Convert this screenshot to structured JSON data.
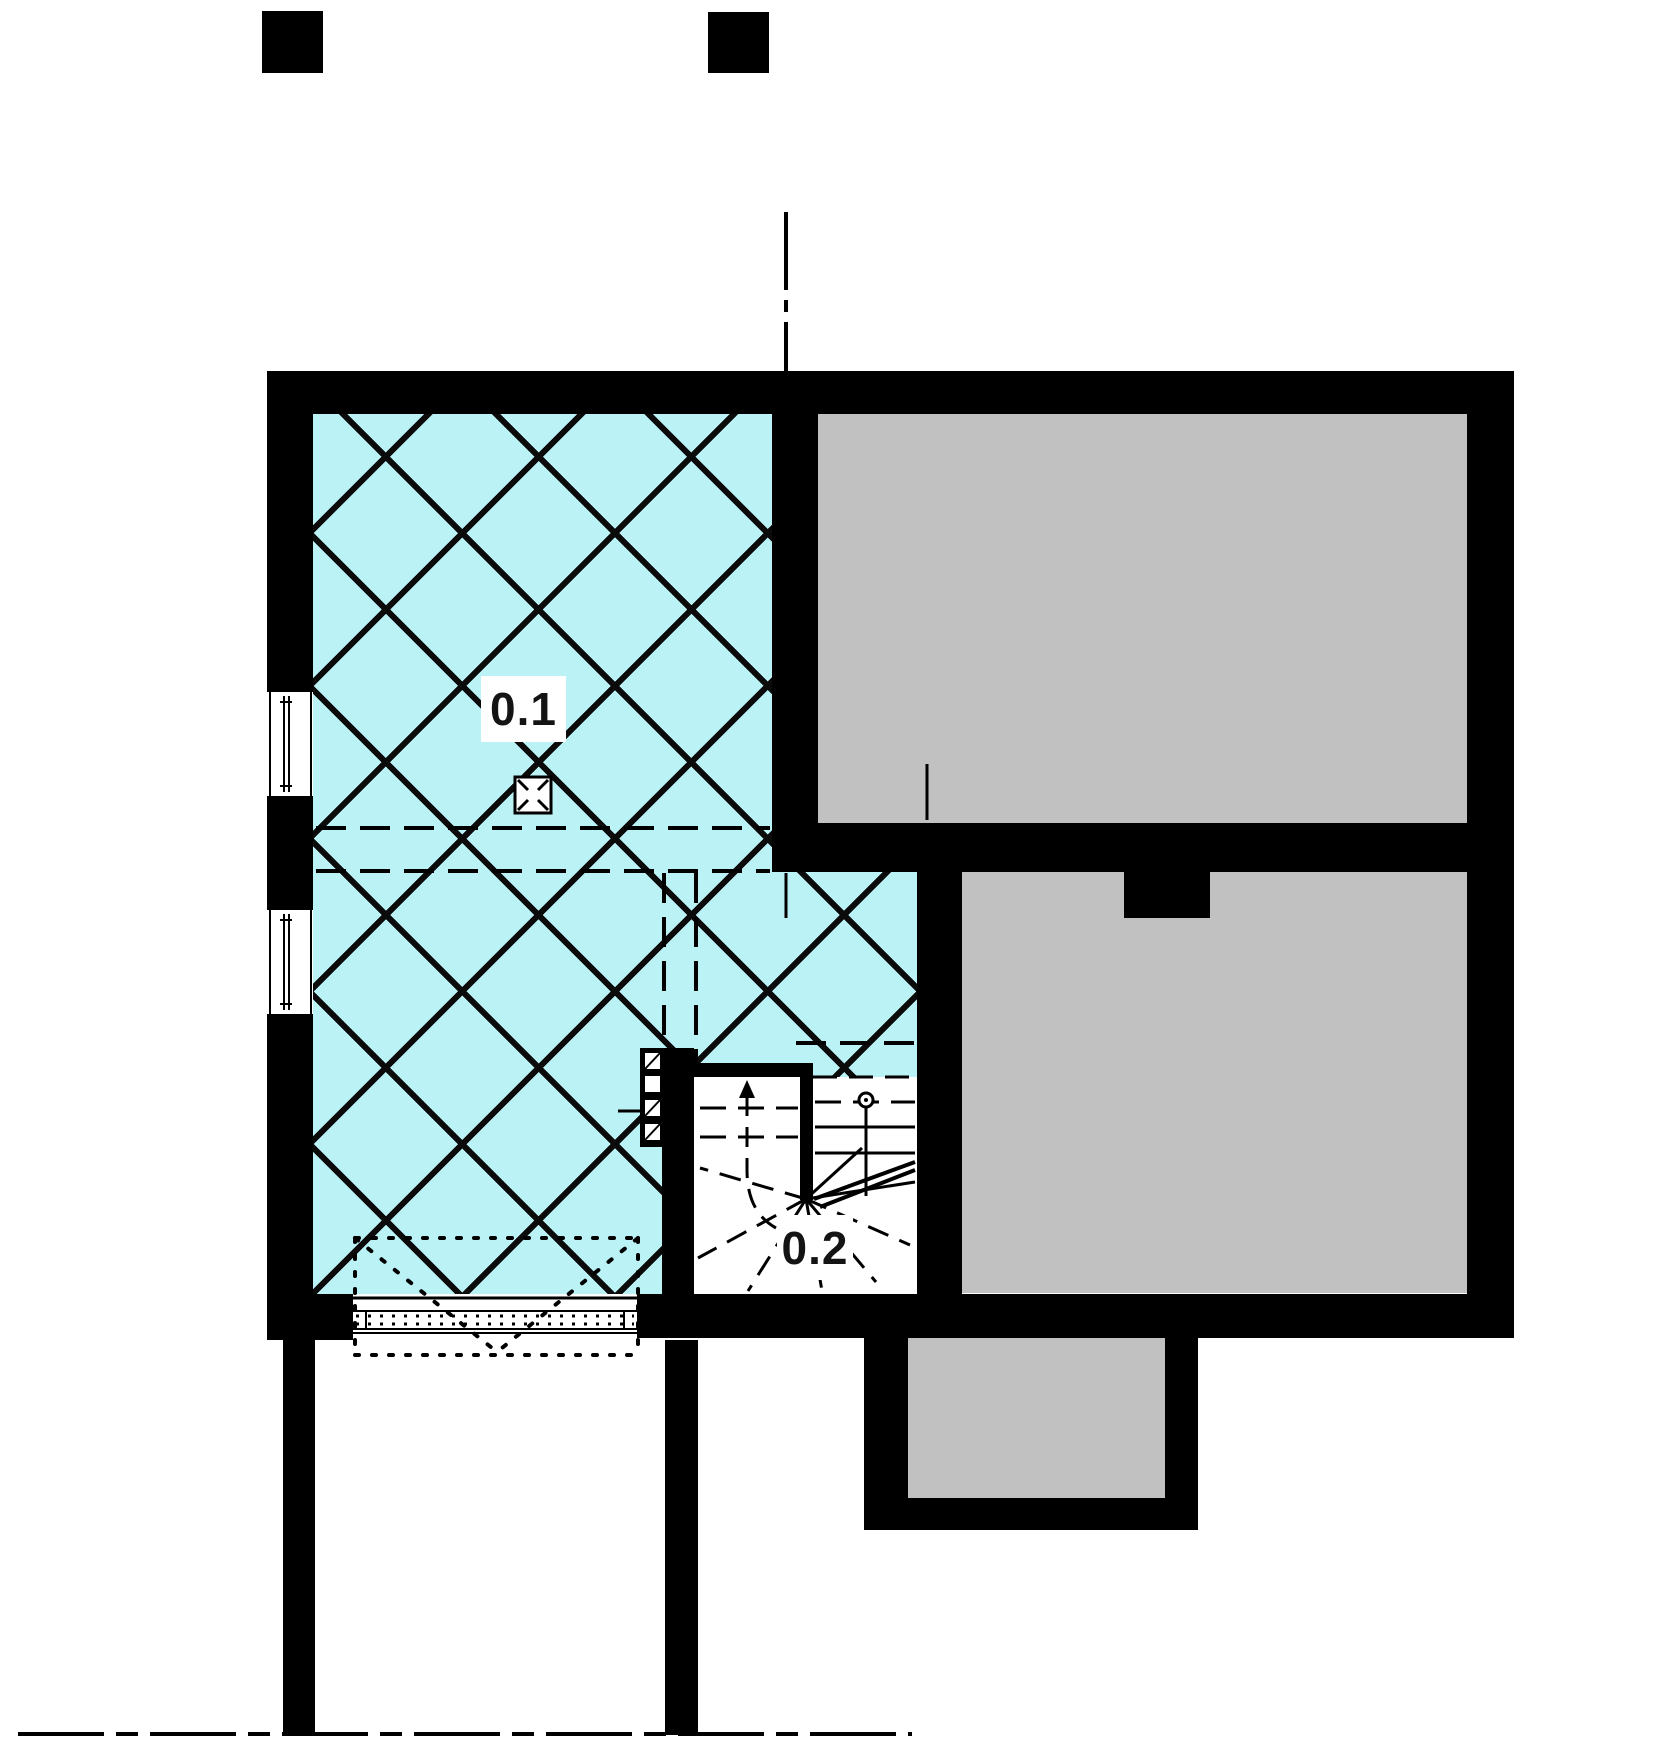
{
  "title": "Basement floor plan",
  "labels": {
    "room1": "0.1",
    "room2": "0.2"
  },
  "rooms": [
    {
      "id": "0.1",
      "kind": "hatched-room"
    },
    {
      "id": "0.2",
      "kind": "winder-staircase"
    }
  ],
  "symbols": [
    "column-marker",
    "center-axis-line",
    "window",
    "basement-window-opening",
    "floor-drain",
    "stair-up-arrow",
    "handrail-post",
    "terrace-outline"
  ],
  "colors": {
    "wall": "#000000",
    "hatch_room_fill": "#baf2f6",
    "unexcavated_fill": "#c1c1c1",
    "background": "#ffffff",
    "label_text": "#141414"
  }
}
